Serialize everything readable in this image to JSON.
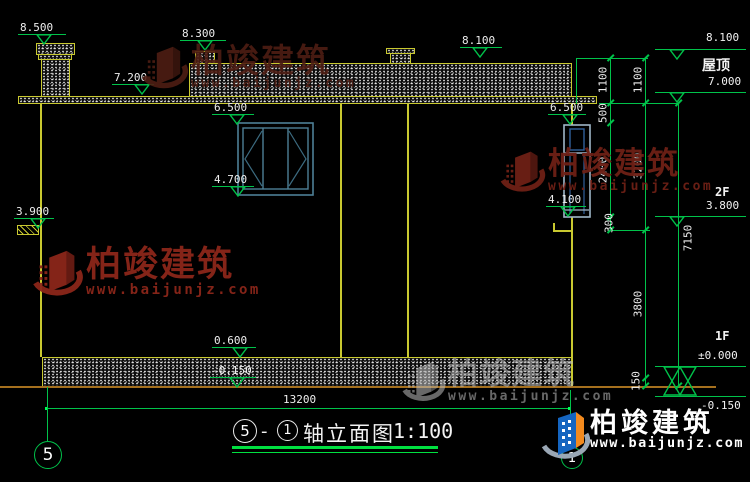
{
  "watermark": {
    "brand": "柏竣建筑",
    "url": "www.baijunjz.com"
  },
  "levels": {
    "v8500": "8.500",
    "v8300": "8.300",
    "v7200": "7.200",
    "v8100": "8.100",
    "v6500": "6.500",
    "v4700": "4.700",
    "v4100": "4.100",
    "v3900": "3.900",
    "v0600": "0.600",
    "vm0150": "-0.150",
    "v7000": "7.000",
    "v3800": "3.800",
    "v0000": "±0.000"
  },
  "labels": {
    "roof": "屋顶",
    "f2": "2F",
    "f1": "1F"
  },
  "dims": {
    "a": [
      "1100",
      "500",
      "2400",
      "300"
    ],
    "b": [
      "1100",
      "3200",
      "3800",
      "150"
    ],
    "height_total": "7150",
    "width_total": "13200"
  },
  "title": {
    "axis_left": "5",
    "dash": "-",
    "axis_right": "1",
    "name": "轴立面图",
    "scale": "1:100"
  },
  "axis": {
    "left": "5",
    "right": "1"
  },
  "colors": {
    "dim_green": "#00C24A",
    "wall_yellow": "#C9C930",
    "ground_brown": "#A5701E",
    "watermark_red": "#6E2016",
    "logo_blue": "#1565C0",
    "logo_orange": "#F28A1E"
  }
}
